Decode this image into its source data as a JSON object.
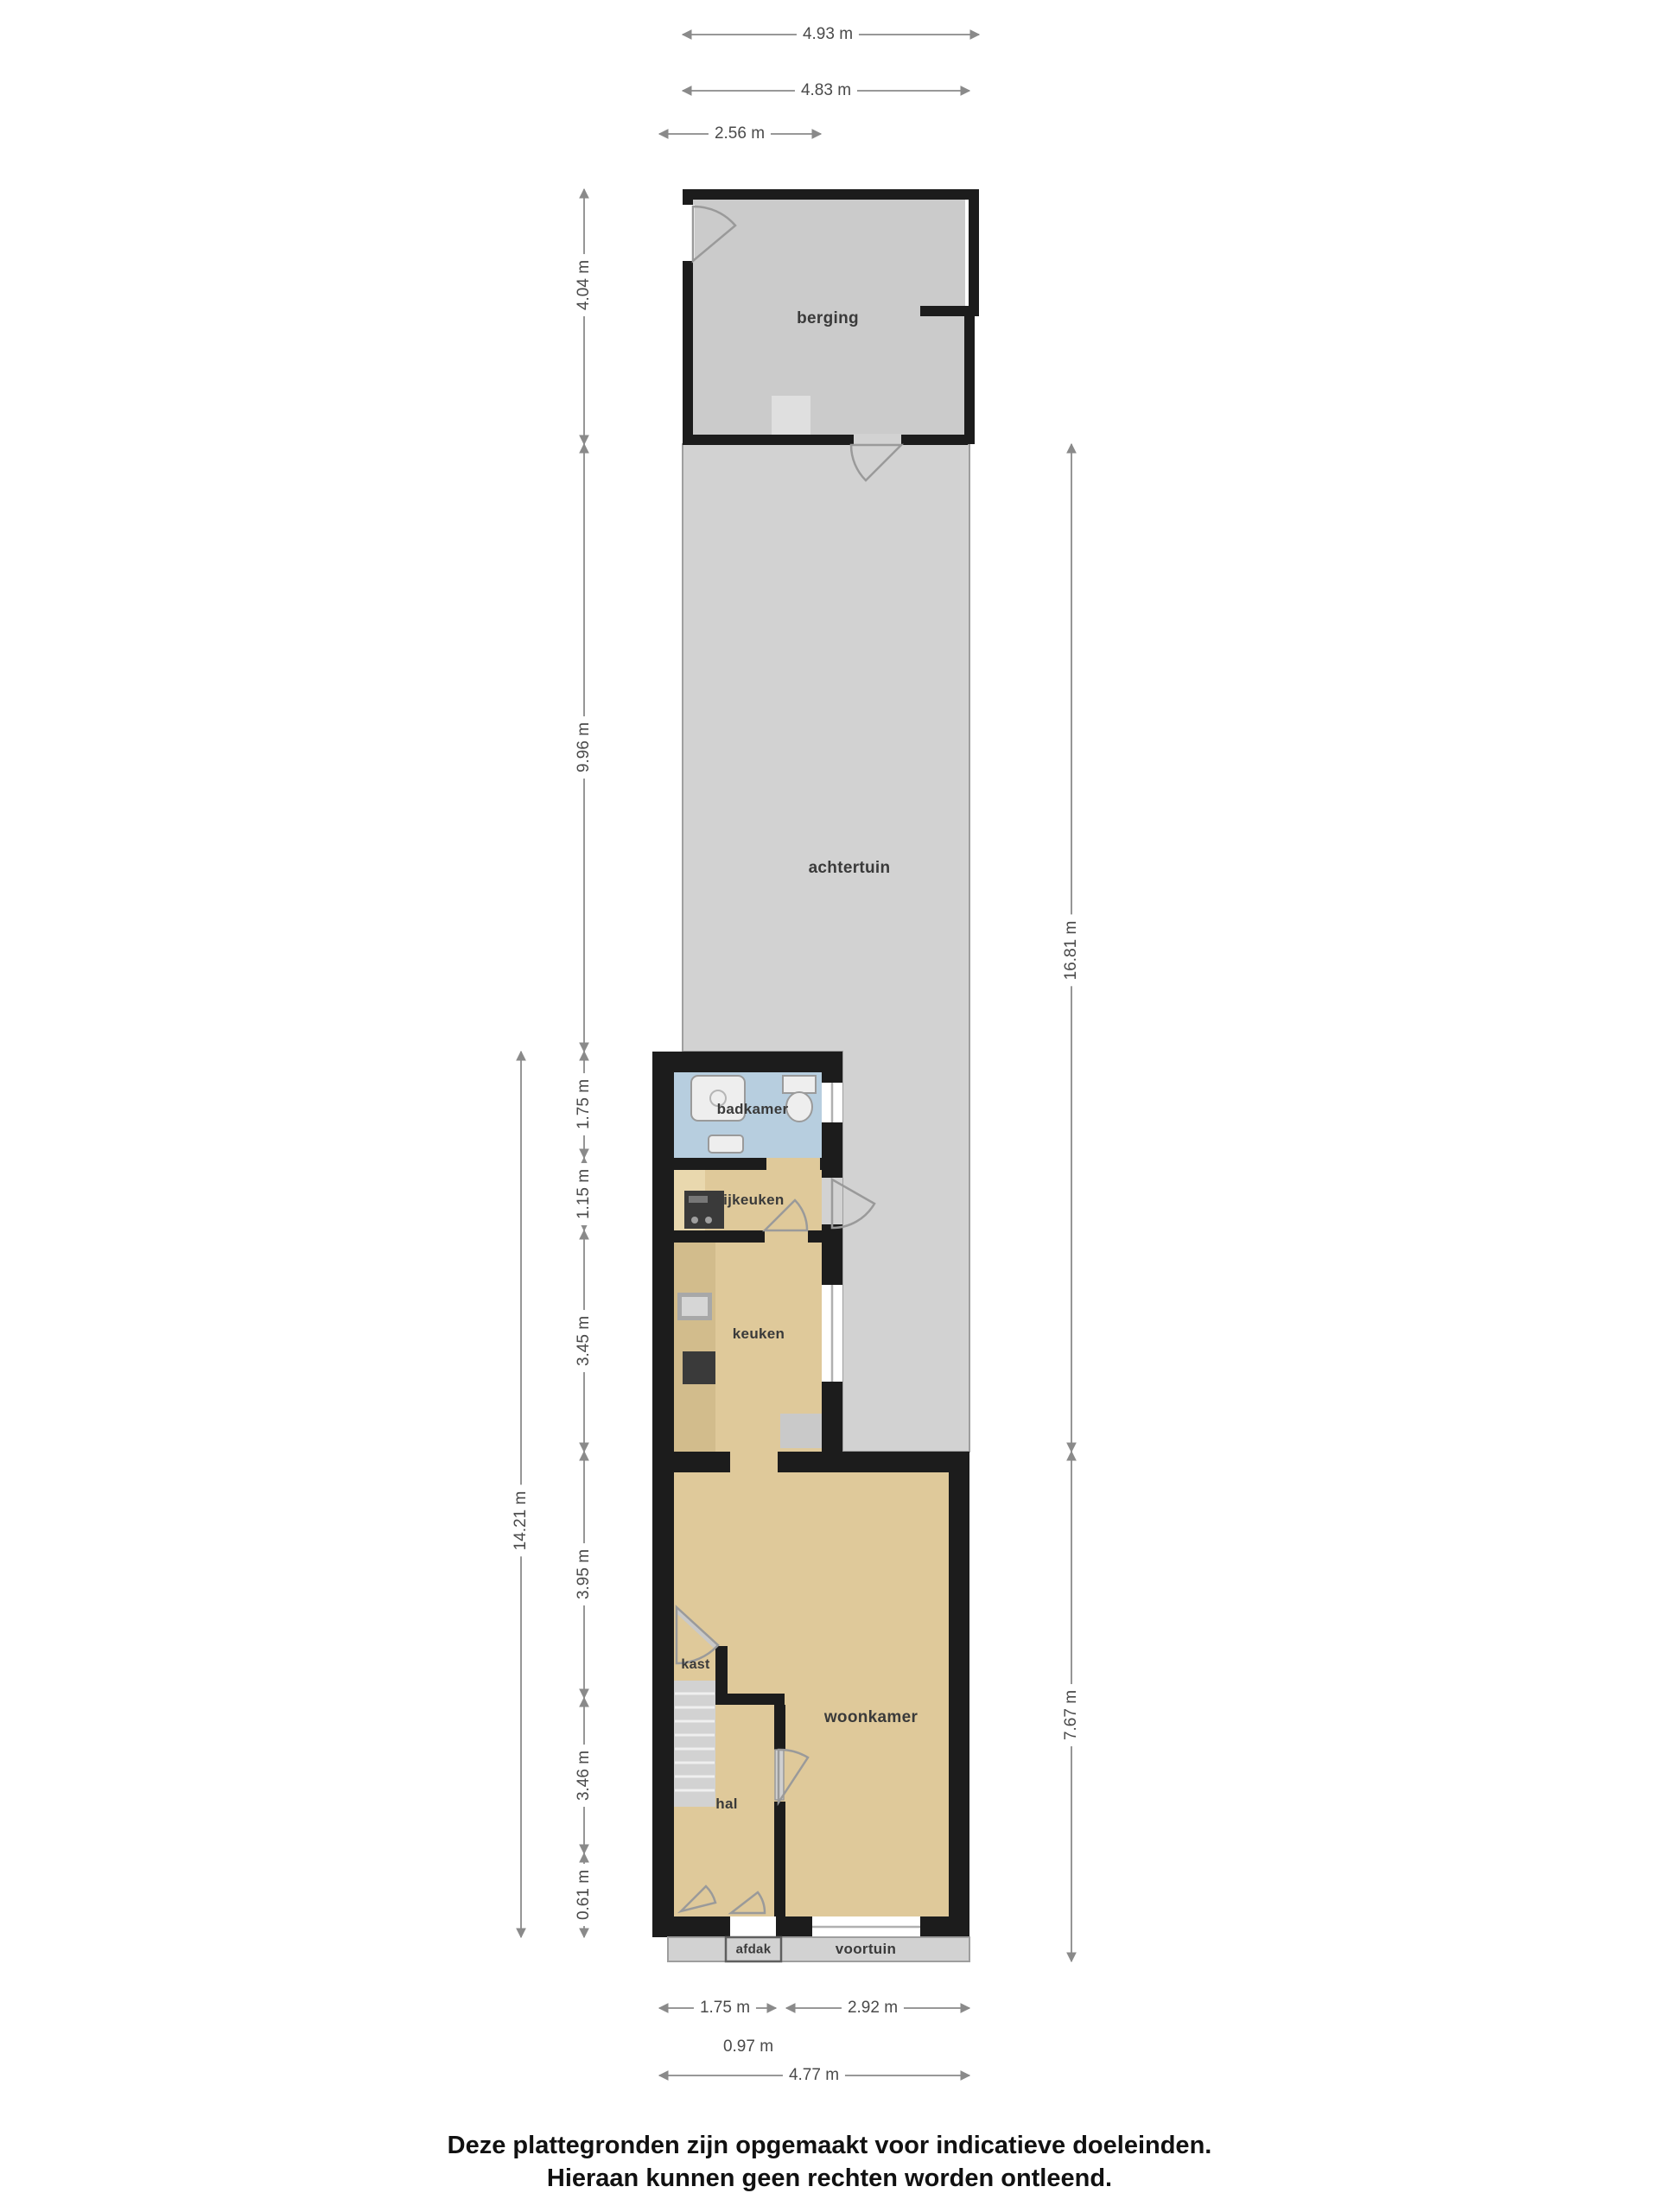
{
  "rooms": {
    "berging": "berging",
    "achtertuin": "achtertuin",
    "badkamer": "badkamer",
    "bijkeuken": "bijkeuken",
    "keuken": "keuken",
    "kast": "kast",
    "woonkamer": "woonkamer",
    "hal": "hal",
    "afdak": "afdak",
    "voortuin": "voortuin"
  },
  "dimensions": {
    "top": [
      "4.93 m",
      "4.83 m",
      "2.56 m"
    ],
    "left": [
      "4.04 m",
      "9.96 m",
      "1.75 m",
      "1.15 m",
      "3.45 m",
      "3.95 m",
      "3.46 m",
      "0.61 m",
      "14.21 m"
    ],
    "right": [
      "16.81 m",
      "7.67 m"
    ],
    "bottom": [
      "1.75 m",
      "2.92 m",
      "0.97 m",
      "4.77 m"
    ]
  },
  "footer": {
    "line1": "Deze plattegronden zijn opgemaakt voor indicatieve doeleinden.",
    "line2": "Hieraan kunnen geen rechten worden ontleend."
  },
  "colors": {
    "wall": "#1c1c1c",
    "garden": "#d2d2d2",
    "berging_floor": "#cbcbcb",
    "room": "#dfc99a",
    "bathroom": "#b7cedf",
    "counter": "#d2bc8c",
    "counter_light": "#e9d8ae",
    "fixture": "#eeeeee",
    "appliance_dark": "#3a3a3a",
    "stairs": "#d2d2d2",
    "dim": "#8a8a8a",
    "door_arc": "#9a9a9a",
    "outline": "#9e9e9e"
  }
}
